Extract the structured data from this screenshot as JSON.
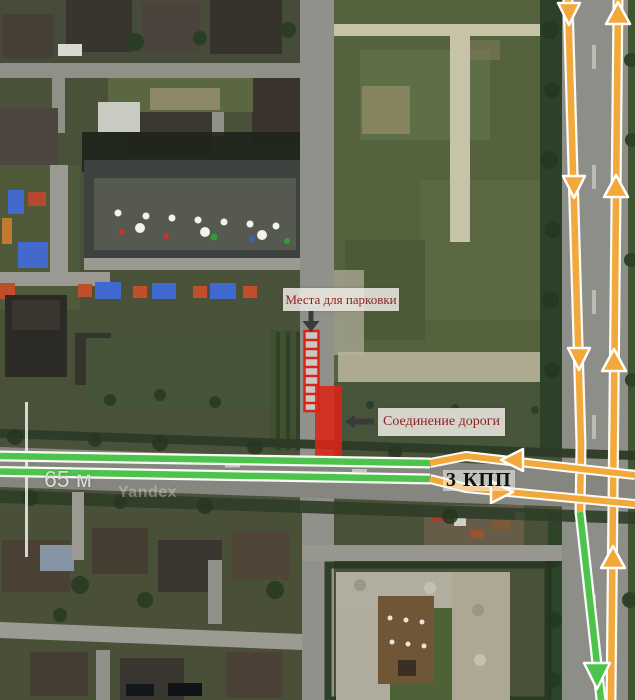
{
  "map": {
    "watermark": "Yandex",
    "scale_label": "65 м"
  },
  "annotations": {
    "parking_label": "Места для парковки",
    "road_connection_label": "Соединение дороги",
    "checkpoint_label": "3 КПП"
  },
  "colors": {
    "route_green": "#4cc44b",
    "route_orange": "#f2a83a",
    "annotation_red": "#da2418",
    "label_red": "#8c2323",
    "checkpoint_color": "#0e0e0e",
    "arrow_dark": "#3b3b3b",
    "casing_white": "#fbfbf7"
  }
}
